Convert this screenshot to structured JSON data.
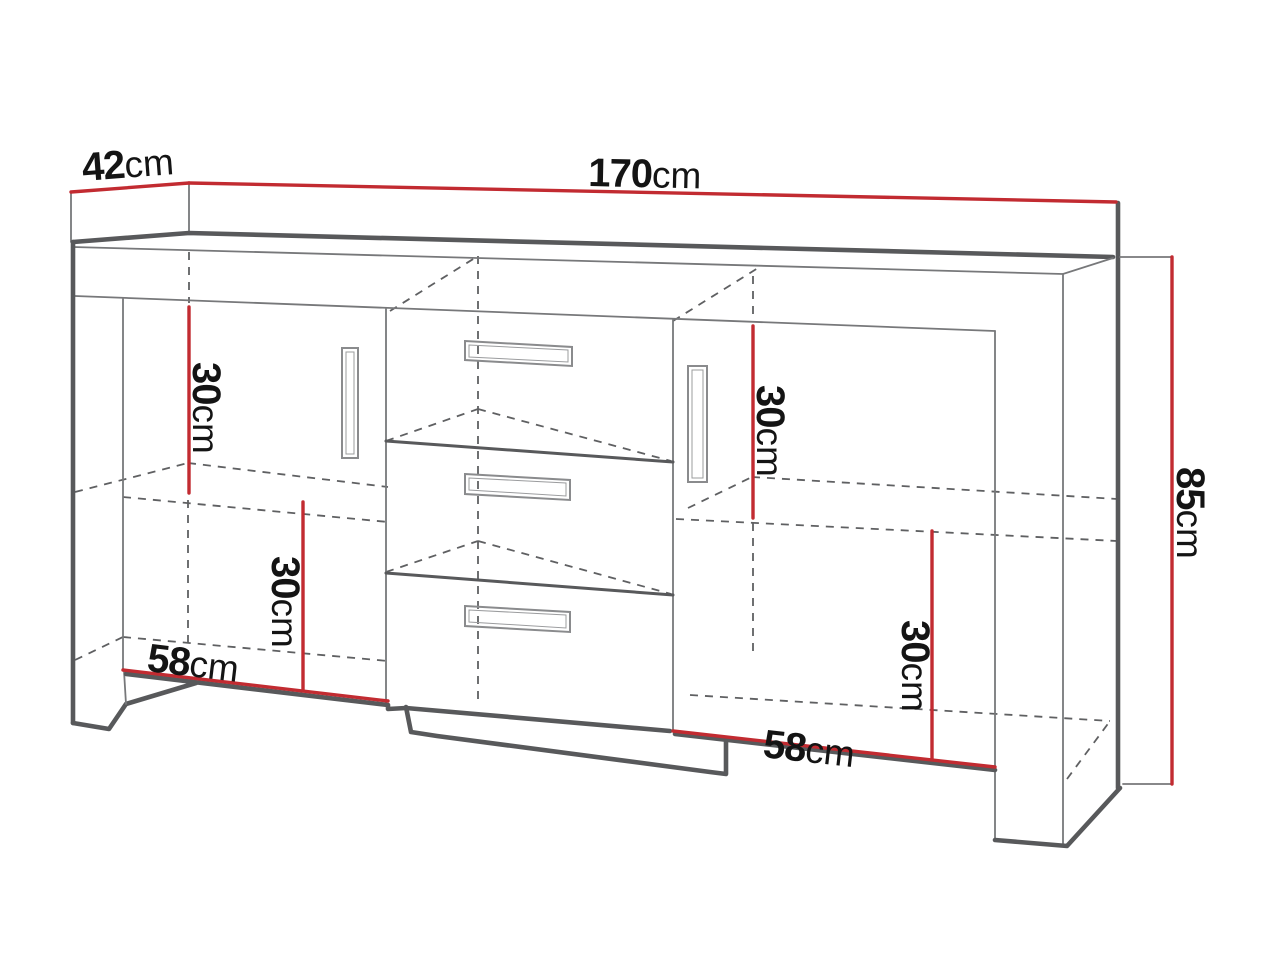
{
  "colors": {
    "dimension_red": "#c22b31",
    "line_dark": "#58595b",
    "text_color": "#141414",
    "background": "#ffffff"
  },
  "labels": {
    "depth": {
      "value": "42",
      "unit": "cm"
    },
    "width": {
      "value": "170",
      "unit": "cm"
    },
    "height": {
      "value": "85",
      "unit": "cm"
    },
    "left_top_compartment_height": {
      "value": "30",
      "unit": "cm"
    },
    "left_bottom_compartment_height": {
      "value": "30",
      "unit": "cm"
    },
    "right_top_compartment_height": {
      "value": "30",
      "unit": "cm"
    },
    "right_bottom_compartment_height": {
      "value": "30",
      "unit": "cm"
    },
    "left_compartment_width": {
      "value": "58",
      "unit": "cm"
    },
    "right_compartment_width": {
      "value": "58",
      "unit": "cm"
    }
  }
}
